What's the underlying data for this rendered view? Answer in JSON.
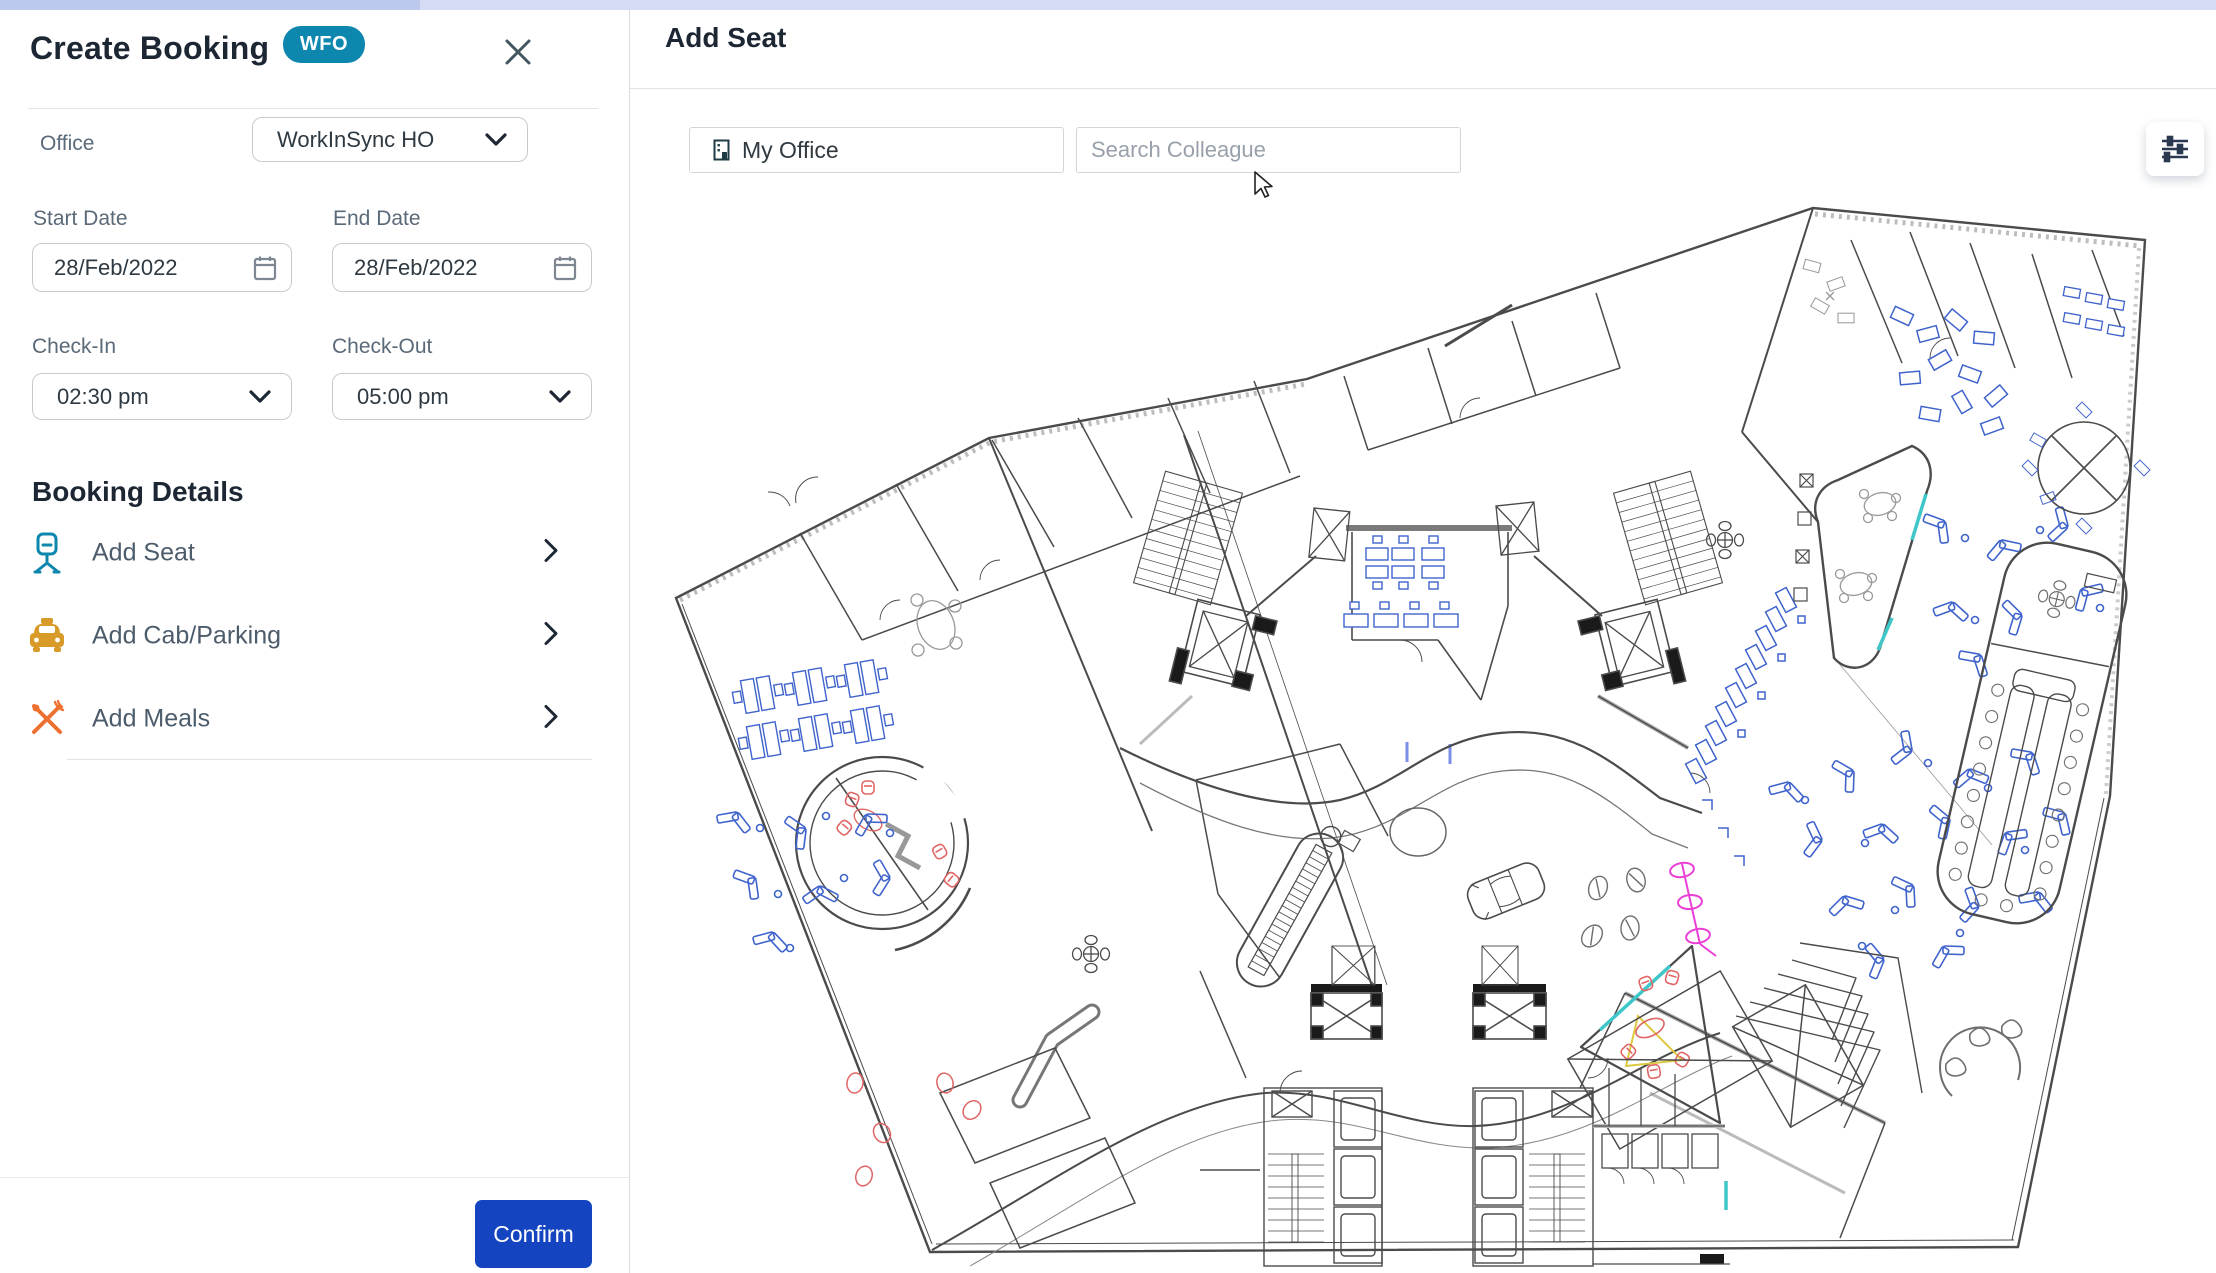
{
  "booking_panel": {
    "title": "Create Booking",
    "badge": "WFO",
    "office_label": "Office",
    "office_value": "WorkInSync HO",
    "start_date_label": "Start Date",
    "start_date_value": "28/Feb/2022",
    "end_date_label": "End Date",
    "end_date_value": "28/Feb/2022",
    "check_in_label": "Check-In",
    "check_in_value": "02:30 pm",
    "check_out_label": "Check-Out",
    "check_out_value": "05:00 pm",
    "section_title": "Booking Details",
    "items": [
      {
        "label": "Add Seat",
        "icon": "chair-icon"
      },
      {
        "label": "Add Cab/Parking",
        "icon": "taxi-icon"
      },
      {
        "label": "Add Meals",
        "icon": "meals-icon"
      }
    ],
    "confirm_label": "Confirm"
  },
  "seat_panel": {
    "title": "Add Seat",
    "my_office_label": "My Office",
    "search_placeholder": "Search Colleague"
  },
  "colors": {
    "badge_bg": "#0e87ae",
    "confirm_bg": "#1544c1",
    "seat_icon_teal": "#0e87ae",
    "cab_icon_amber": "#d89a28",
    "meals_icon_orange": "#ed7030",
    "heading_navy": "#1d2734",
    "label_grey": "#5b6a78",
    "plan_furniture_blue": "#3f63cc",
    "plan_accent_red": "#e06565",
    "plan_accent_pink": "#ea3fd6",
    "plan_accent_teal": "#3fc6c9",
    "plan_accent_yellow": "#ddc83f"
  }
}
